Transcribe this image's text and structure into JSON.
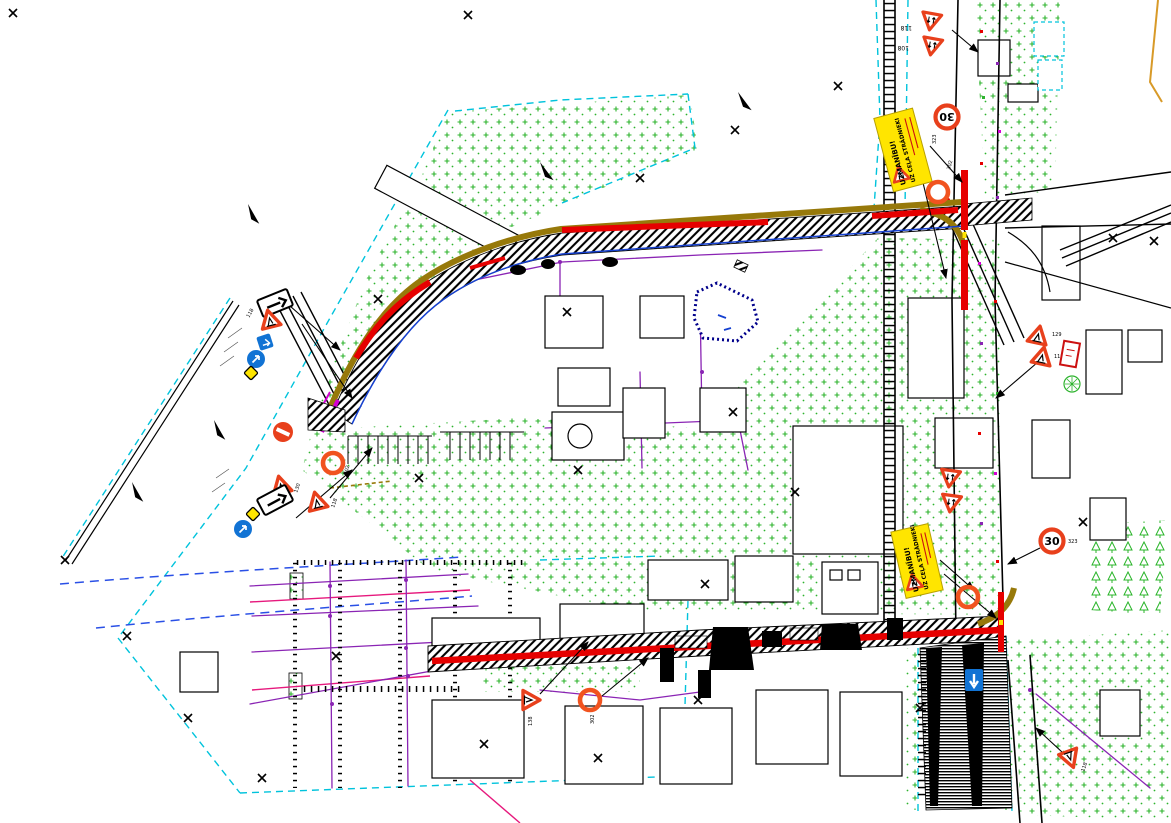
{
  "colors": {
    "background": "#ffffff",
    "parcel_cyan": "#00c3dc",
    "vegetation_green": "#2db32d",
    "road_edge_olive": "#97790a",
    "closure_red": "#e60000",
    "sign_red_orange": "#e8401c",
    "ring_orange": "#f1531f",
    "utility_magenta": "#d400d4",
    "utility_purple": "#8a24b4",
    "line_blue": "#1540d0",
    "dashed_blue": "#2a50e6",
    "line_pink": "#e6197d",
    "board_yellow": "#ffe500",
    "sign_blue": "#1173d4",
    "boundary_orange": "#d89a28",
    "pond_border_blue": "#00008b"
  },
  "info_boards": {
    "top": {
      "line1": "UZMANĪBU!",
      "line2": "UZ CEĻA STRĀDNIEKI"
    },
    "bottom": {
      "line1": "UZMANĪBU!",
      "line2": "UZ CEĻA STRĀDNIEKI"
    }
  },
  "signs": {
    "speed_top": {
      "value": "30",
      "code": "323"
    },
    "speed_right": {
      "value": "30",
      "code": "323"
    },
    "yield_top_1": {
      "code": "118"
    },
    "yield_top_2": {
      "code": "108"
    },
    "ring_top": {
      "code": "302"
    },
    "ring_left": {
      "code": "302"
    },
    "ring_bottom": {
      "code": "302"
    },
    "tri_left_a": {
      "code": "118"
    },
    "tri_left_b": {
      "code": "130"
    },
    "tri_left_c": {
      "code": "118"
    },
    "tri_bottom": {
      "code": "138"
    },
    "tri_right_a": {
      "code": "129"
    },
    "tri_right_b": {
      "code": "118"
    },
    "tri_bottom_right": {
      "code": "118"
    }
  }
}
